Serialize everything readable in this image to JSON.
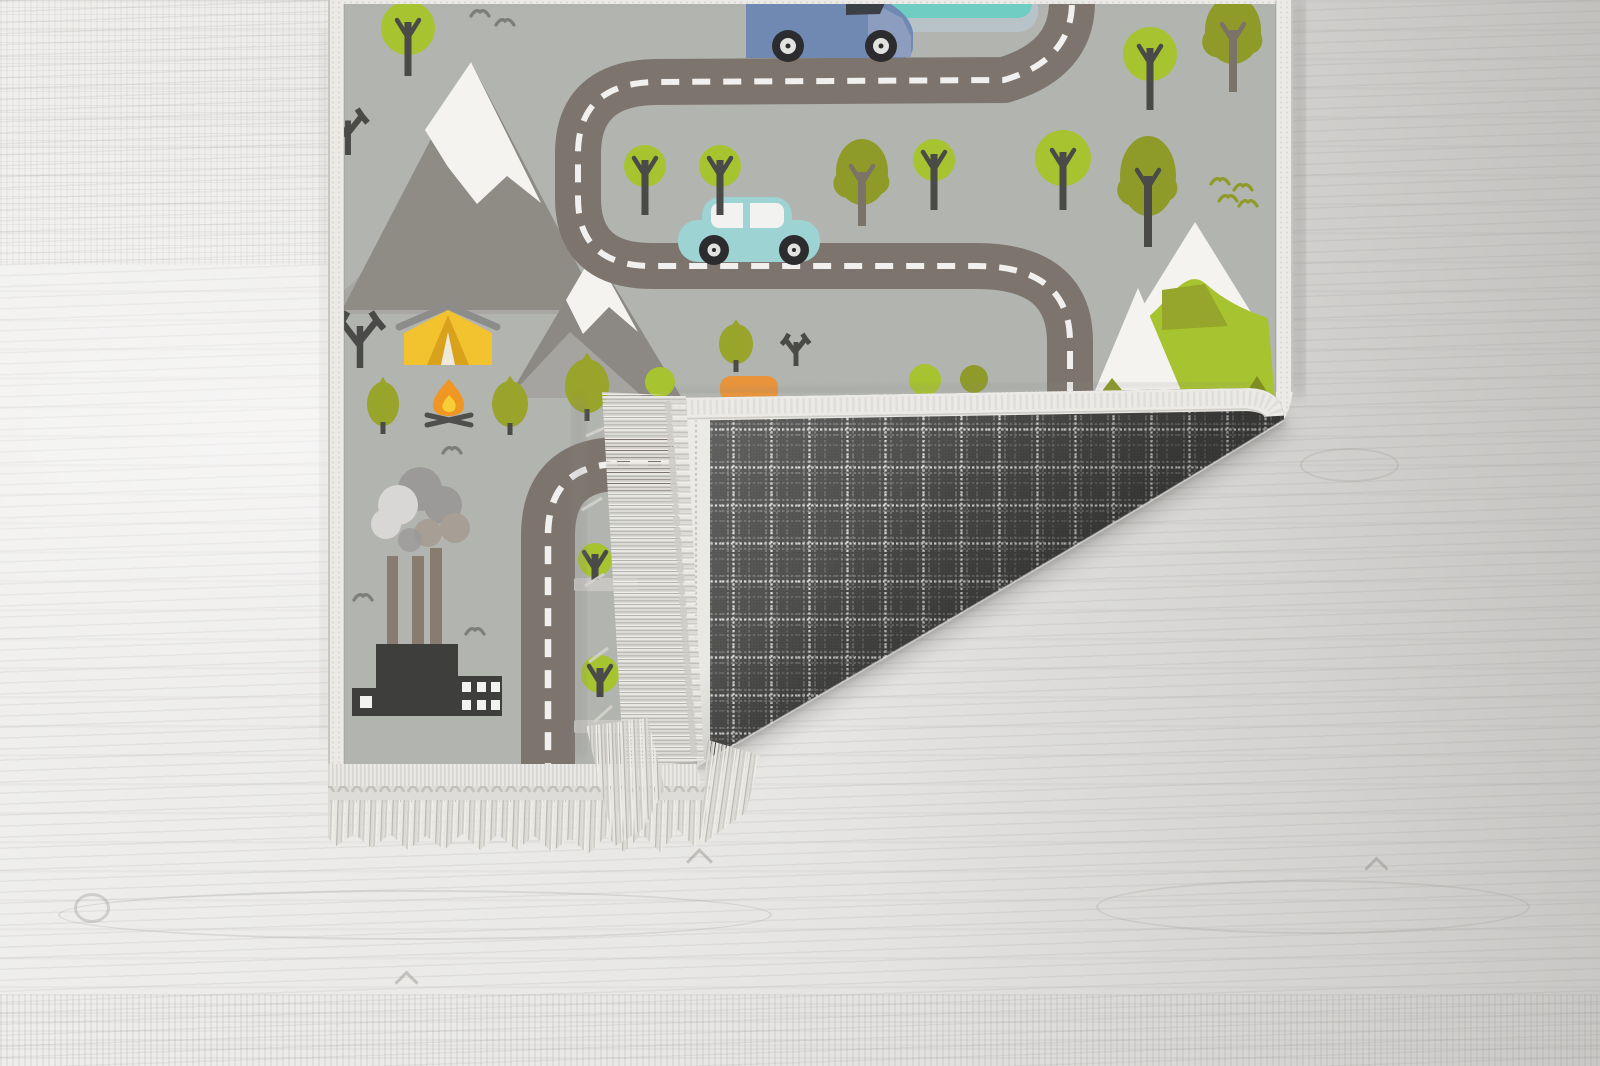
{
  "scene": {
    "type": "product-photo",
    "subject": "Children's road-map play rug with its bottom-right corner folded over, revealing a dark plaid woven backing and tassel fringe, lying on a whitewashed wood floor",
    "visible_text": []
  },
  "colors": {
    "floor-light": "#f0efed",
    "floor-mid": "#e6e5e3",
    "floor-dark": "#d8d7d5",
    "rug-bg": "#b2b4b0",
    "trim": "#eceae6",
    "trim-stitch": "#cfcdc9",
    "road": "#7d756d",
    "road-dash": "#f1f0ee",
    "mountain-gray": "#8f8b85",
    "mountain-gray-light": "#a9a7a3",
    "snow": "#f4f3f0",
    "green-bright": "#a7c32f",
    "green-olive": "#8e9b28",
    "green-dark-olive": "#7f8d22",
    "trunk-dark": "#4a4a48",
    "trunk-taupe": "#7b7268",
    "tent-yellow": "#f2c32e",
    "tent-shade": "#d9a21d",
    "tent-ridge": "#8c8c8a",
    "fire-orange": "#ef9722",
    "fire-yellow": "#f7ce36",
    "factory-dark": "#3e3e3c",
    "chimney-taupe": "#887b6f",
    "smoke-gray": "#9b9a98",
    "smoke-light": "#d8d7d5",
    "smoke-taupe": "#a79e96",
    "van-blue": "#7089b3",
    "van-hood": "#8c9dc0",
    "window-dark": "#3d3f47",
    "car-teal": "#9dd3d2",
    "window-white": "#f2f2f0",
    "wheel-dark": "#2c2c2e",
    "wheel-light": "#e2e2e0",
    "pond-teal": "#6fcdc4",
    "pond-shore": "#b7c3c8",
    "plaid-base": "#4a4a49",
    "plaid-line": "#ffffff",
    "fringe-light": "#e9e7e2",
    "fringe-mid": "#d3d1cc",
    "fringe-dark": "#b5b3ae",
    "orange-accent": "#e8943b",
    "crossing-gray": "#c7c6c3"
  },
  "rug": {
    "artwork_theme": "winding roads with dashed lane lines through mountains, forest, campsite and factory town",
    "backing": {
      "pattern": "windowpane plaid weave",
      "description": "dark charcoal fabric with dotted white grid lines"
    },
    "fringe": {
      "style": "knotted tassel fringe on rug ends"
    },
    "trees_round": [
      {
        "x": 408,
        "y": 28,
        "r": 27,
        "trunk": 76
      },
      {
        "x": 645,
        "y": 166,
        "r": 21,
        "trunk": 215
      },
      {
        "x": 720,
        "y": 166,
        "r": 21,
        "trunk": 215
      },
      {
        "x": 934,
        "y": 160,
        "r": 21,
        "trunk": 210
      },
      {
        "x": 1063,
        "y": 158,
        "r": 28,
        "trunk": 210
      },
      {
        "x": 1150,
        "y": 54,
        "r": 27,
        "trunk": 110
      },
      {
        "x": 595,
        "y": 560,
        "r": 17,
        "trunk": 580
      },
      {
        "x": 600,
        "y": 674,
        "r": 19,
        "trunk": 697
      }
    ],
    "trees_olive": [
      {
        "x": 862,
        "y": 172,
        "rx": 26,
        "ry": 33,
        "trunk": 226,
        "trunk_color": "taupe"
      },
      {
        "x": 1148,
        "y": 176,
        "rx": 28,
        "ry": 40,
        "trunk": 247,
        "trunk_color": "dark"
      },
      {
        "x": 1233,
        "y": 30,
        "rx": 28,
        "ry": 34,
        "trunk": 92,
        "trunk_color": "taupe"
      }
    ],
    "trees_small": [
      {
        "x": 383,
        "y": 404,
        "w": 32,
        "h": 44
      },
      {
        "x": 510,
        "y": 404,
        "w": 36,
        "h": 46
      },
      {
        "x": 587,
        "y": 386,
        "w": 44,
        "h": 54
      },
      {
        "x": 736,
        "y": 344,
        "w": 34,
        "h": 40
      }
    ],
    "trees_bare": [
      {
        "x": 360,
        "y": 368,
        "s": 1.4
      },
      {
        "x": 348,
        "y": 155,
        "s": 1.15
      },
      {
        "x": 796,
        "y": 366,
        "s": 0.8
      }
    ],
    "birds_gray": [
      {
        "x": 480,
        "y": 10
      },
      {
        "x": 505,
        "y": 19
      },
      {
        "x": 452,
        "y": 447
      },
      {
        "x": 363,
        "y": 594
      },
      {
        "x": 475,
        "y": 628
      }
    ],
    "birds_olive": [
      {
        "x": 1220,
        "y": 178
      },
      {
        "x": 1243,
        "y": 184
      },
      {
        "x": 1228,
        "y": 195
      },
      {
        "x": 1248,
        "y": 200
      }
    ]
  },
  "floor": {
    "material": "whitewashed wood planks",
    "grain_direction": "horizontal",
    "knots": 4
  }
}
